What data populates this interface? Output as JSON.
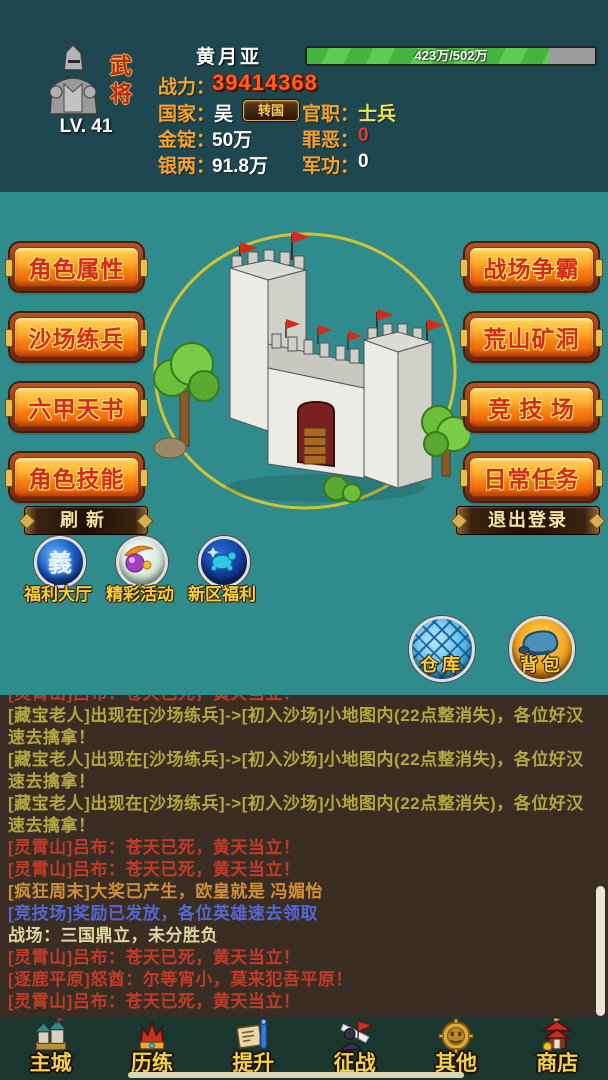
{
  "colors": {
    "header_bg": "#1f4750",
    "main_bg": "#2f8b8c",
    "chat_bg": "#3a2d23",
    "nav_bg": "#1b352f",
    "label_gold": "#f7a22d",
    "power_orange": "#ff6218",
    "xp_green": "#4ab43e",
    "xp_track_grey": "#9b9b9b",
    "button_face_orange": "#f67f12",
    "button_text_red": "#d4291c",
    "button_outline_gold": "#ffe06a",
    "chat_red": "#c23b28",
    "chat_yellow": "#b3a83f",
    "chat_orange": "#d08f3a",
    "chat_blue": "#5468d4",
    "chat_pale": "#ddd8a0",
    "nav_label_yellow": "#f2d24a"
  },
  "header": {
    "class_badge": "武将",
    "level": "LV. 41",
    "name": "黄月亚",
    "xp_text": "423万/502万",
    "xp_percent": 84,
    "power_label": "战力：",
    "power_value": "39414368",
    "country_label": "国家：",
    "country_value": "吴",
    "transfer_button": "转国",
    "rank_label": "官职：",
    "rank_value": "士兵",
    "gold_label": "金锭：",
    "gold_value": "50万",
    "sin_label": "罪恶：",
    "sin_value": "0",
    "silver_label": "银两：",
    "silver_value": "91.8万",
    "merit_label": "军功：",
    "merit_value": "0"
  },
  "main": {
    "left_buttons": [
      {
        "label": "角色属性"
      },
      {
        "label": "沙场练兵"
      },
      {
        "label": "六甲天书"
      },
      {
        "label": "角色技能"
      }
    ],
    "right_buttons": [
      {
        "label": "战场争霸"
      },
      {
        "label": "荒山矿洞"
      },
      {
        "label": "竞 技 场"
      },
      {
        "label": "日常任务"
      }
    ],
    "refresh_button": "刷新",
    "logout_button": "退出登录",
    "feature_icons": [
      {
        "label": "福利大厅",
        "icon": "welfare-hall-orb-icon",
        "glyph": "義"
      },
      {
        "label": "精彩活动",
        "icon": "activities-swirl-orb-icon"
      },
      {
        "label": "新区福利",
        "icon": "new-zone-orb-icon"
      }
    ],
    "storage_icons": [
      {
        "label": "仓库",
        "icon": "warehouse-globe-icon"
      },
      {
        "label": "背包",
        "icon": "backpack-orb-icon"
      }
    ]
  },
  "chat": {
    "messages": [
      {
        "text": "[灵霄山]吕布：苍天已死，黄天当立！",
        "color": "red"
      },
      {
        "text": "[藏宝老人]出现在[沙场练兵]->[初入沙场]小地图内(22点整消失)，各位好汉速去擒拿！",
        "color": "yellow"
      },
      {
        "text": "[藏宝老人]出现在[沙场练兵]->[初入沙场]小地图内(22点整消失)，各位好汉速去擒拿！",
        "color": "yellow"
      },
      {
        "text": "[藏宝老人]出现在[沙场练兵]->[初入沙场]小地图内(22点整消失)，各位好汉速去擒拿！",
        "color": "yellow"
      },
      {
        "text": "[灵霄山]吕布：苍天已死，黄天当立！",
        "color": "red"
      },
      {
        "text": "[灵霄山]吕布：苍天已死，黄天当立！",
        "color": "red"
      },
      {
        "text": "[疯狂周末]大奖已产生，欧皇就是 冯媚怡",
        "color": "orange"
      },
      {
        "text": "[竞技场]奖励已发放，各位英雄速去领取",
        "color": "blue"
      },
      {
        "text": "战场：三国鼎立，未分胜负",
        "color": "pale"
      },
      {
        "text": "[灵霄山]吕布：苍天已死，黄天当立！",
        "color": "red"
      },
      {
        "text": "[逐鹿平原]怒酋：尔等宵小，莫来犯吾平原！",
        "color": "red"
      },
      {
        "text": "[灵霄山]吕布：苍天已死，黄天当立！",
        "color": "red"
      }
    ]
  },
  "nav": {
    "items": [
      {
        "label": "主城",
        "icon": "main-city-icon"
      },
      {
        "label": "历练",
        "icon": "training-icon"
      },
      {
        "label": "提升",
        "icon": "upgrade-icon"
      },
      {
        "label": "征战",
        "icon": "battle-icon"
      },
      {
        "label": "其他",
        "icon": "others-icon"
      },
      {
        "label": "商店",
        "icon": "shop-icon"
      }
    ]
  }
}
